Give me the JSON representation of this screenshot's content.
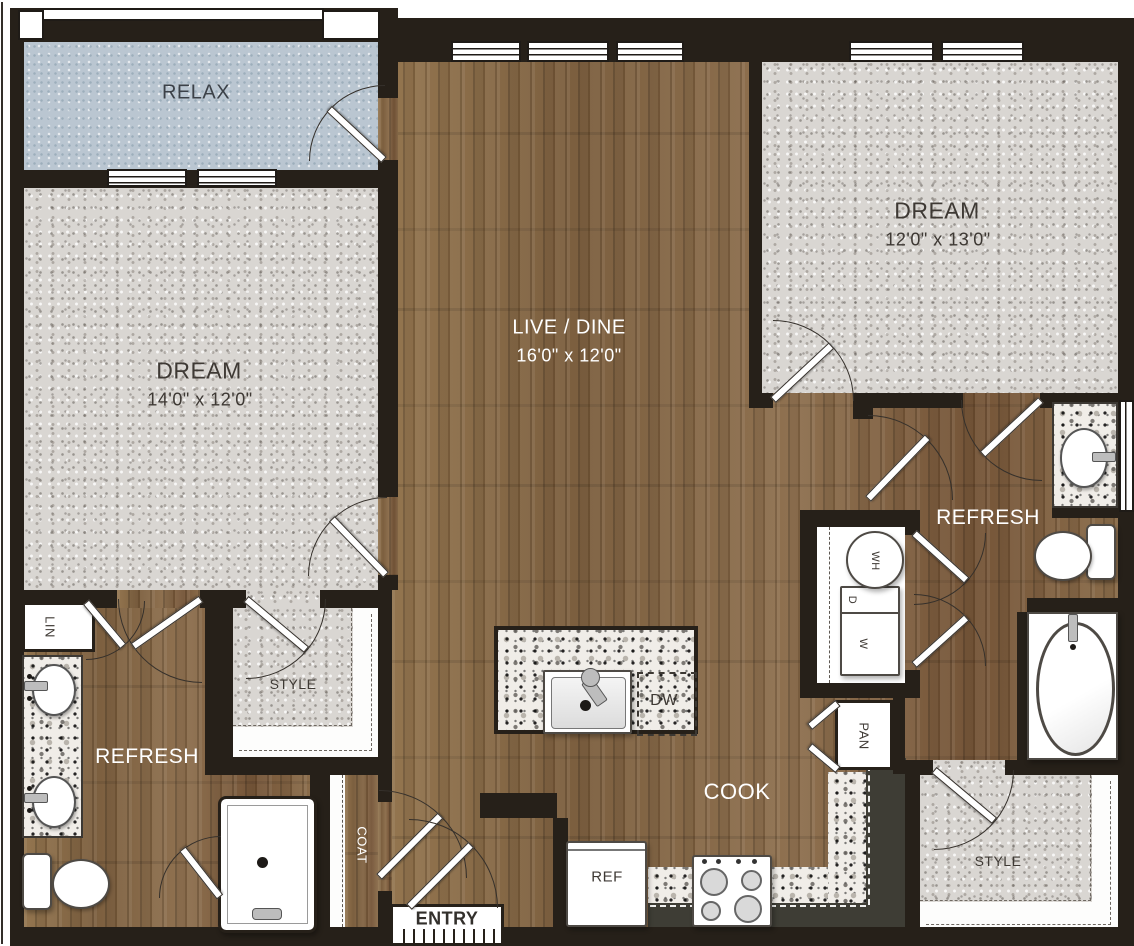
{
  "rooms": {
    "relax": {
      "label": "RELAX"
    },
    "dream_left": {
      "label": "DREAM",
      "dims": "14'0\" x 12'0\""
    },
    "live_dine": {
      "label": "LIVE / DINE",
      "dims": "16'0\" x 12'0\""
    },
    "dream_right": {
      "label": "DREAM",
      "dims": "12'0\" x 13'0\""
    },
    "refresh_left": {
      "label": "REFRESH"
    },
    "refresh_right": {
      "label": "REFRESH"
    },
    "style_left": {
      "label": "STYLE"
    },
    "style_right": {
      "label": "STYLE"
    },
    "cook": {
      "label": "COOK"
    },
    "entry": {
      "label": "ENTRY"
    },
    "coat": {
      "label": "COAT"
    },
    "linen": {
      "label": "LIN"
    },
    "pantry": {
      "label": "PAN"
    }
  },
  "fixtures": {
    "dishwasher": {
      "label": "DW"
    },
    "refrigerator": {
      "label": "REF"
    },
    "washer": {
      "label": "W"
    },
    "dryer": {
      "label": "D"
    },
    "water_heater": {
      "label": "WH"
    }
  },
  "colors": {
    "wall": "#262019",
    "wood_floor": "#8a6d4c",
    "carpet": "#d9d6d2",
    "balcony_floor": "#bac6d1",
    "granite": "#f0ede8",
    "cabinet": "#3e3d35",
    "label_dark": "#3e3934",
    "label_light": "#ffffff"
  }
}
